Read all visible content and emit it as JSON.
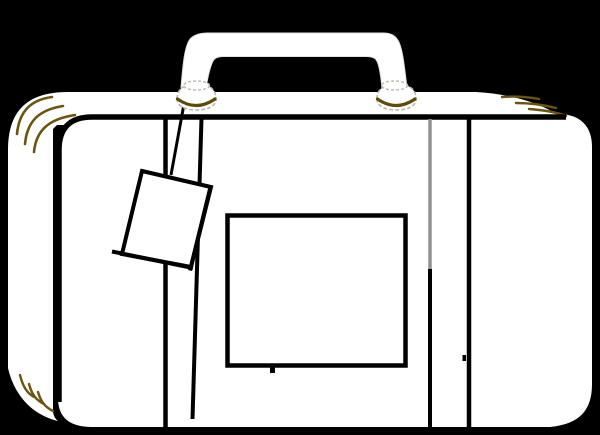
{
  "scene": {
    "title": "suitcase-clipart",
    "description": "White line-art suitcase with handle, two hinges, hanging luggage tag, two vertical straps and a blank label window, on a solid black background",
    "elements": [
      "suitcase-body",
      "lid-band",
      "front-panel",
      "panel-outline",
      "handle",
      "left-hinge",
      "right-hinge",
      "luggage-tag",
      "tag-string",
      "left-strap",
      "right-strap",
      "label-window",
      "corner-decoration-top-left",
      "corner-decoration-top-right",
      "corner-decoration-bottom-left"
    ]
  },
  "colors": {
    "background": "#000000",
    "body": "#ffffff",
    "outline": "#000000",
    "corner_accent": "#6b540f",
    "hinge_accent": "#5e4a0a",
    "hinge_outline": "#b9b9b0",
    "handle_outline": "#e2e2e2",
    "strap_gray": "#909090",
    "none": "none"
  }
}
